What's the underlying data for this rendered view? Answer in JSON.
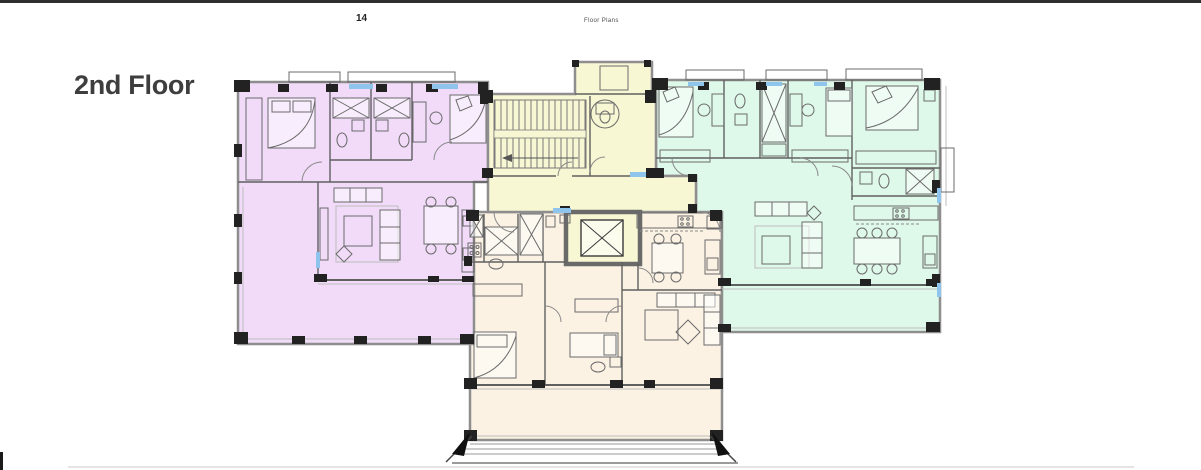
{
  "page": {
    "page_number": "14",
    "header_title": "Floor Plans",
    "section_title": "2nd Floor"
  },
  "colors": {
    "topbar": "#2e2e2e",
    "title": "#3e3e3e",
    "headerText": "#4a4a4a",
    "unitPurple": "#f1dbf8",
    "unitGreen": "#def8e9",
    "unitBeige": "#fbf2e3",
    "commonYellow": "#f8f7d3",
    "wallGray": "#8e8e8e",
    "wallDark": "#222222",
    "line": "#606060",
    "furniture": "#6b6b6b",
    "window": "#8fc4ec",
    "rule": "#dcdcdc"
  }
}
